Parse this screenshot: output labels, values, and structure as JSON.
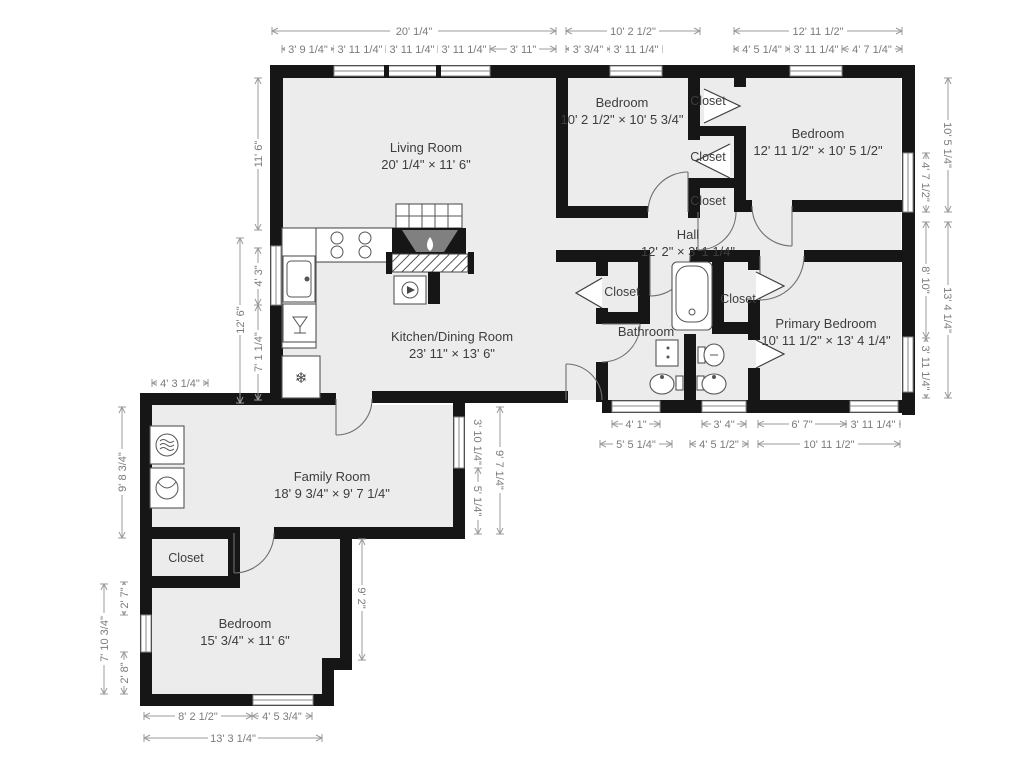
{
  "rooms": {
    "living": {
      "name": "Living Room",
      "dims": "20' 1/4\" × 11' 6\""
    },
    "bedroom1": {
      "name": "Bedroom",
      "dims": "10' 2 1/2\" × 10' 5 3/4\""
    },
    "bedroom2": {
      "name": "Bedroom",
      "dims": "12' 11 1/2\" × 10' 5 1/2\""
    },
    "hall": {
      "name": "Hall",
      "dims": "12' 2\" × 3' 1 1/4\""
    },
    "kitchen": {
      "name": "Kitchen/Dining Room",
      "dims": "23' 11\" × 13' 6\""
    },
    "bathroom": {
      "name": "Bathroom"
    },
    "primary": {
      "name": "Primary Bedroom",
      "dims": "10' 11 1/2\" × 13' 4 1/4\""
    },
    "family": {
      "name": "Family Room",
      "dims": "18' 9 3/4\" × 9' 7 1/4\""
    },
    "bedroom3": {
      "name": "Bedroom",
      "dims": "15' 3/4\" × 11' 6\""
    },
    "closet": "Closet"
  },
  "dims": {
    "top": {
      "living": "20' 1/4\"",
      "living_sub": [
        "3' 9 1/4\"",
        "3' 11 1/4\"",
        "3' 11 1/4\"",
        "3' 11 1/4\"",
        "3' 11\""
      ],
      "bedroom1": "10' 2 1/2\"",
      "bedroom1_sub": [
        "3' 3/4\"",
        "3' 11 1/4\""
      ],
      "bedroom2": "12' 11 1/2\"",
      "bedroom2_sub": [
        "4' 5 1/4\"",
        "3' 11 1/4\"",
        "4' 7 1/4\""
      ]
    },
    "left": {
      "living": "11' 6\"",
      "kitchen": "12' 6\"",
      "kitchen_sub": [
        "4' 3\"",
        "7' 1 1/4\""
      ]
    },
    "right": {
      "bedroom2": "10' 5 1/4\"",
      "bedroom2_sub": "4' 7 1/2\"",
      "primary": "13' 4 1/4\"",
      "primary_sub": [
        "8' 10\"",
        "3' 11 1/4\""
      ]
    },
    "bottom_main": {
      "bath_win": "4' 1\"",
      "bath_width": "5' 5 1/4\"",
      "ensuite_win": "3' 4\"",
      "ensuite_width": "4' 5 1/2\"",
      "primary_sub": [
        "6' 7\"",
        "3' 11 1/4\""
      ],
      "primary": "10' 11 1/2\""
    },
    "family": {
      "top": "4' 3 1/4\"",
      "left": "9' 8 3/4\"",
      "right": "9' 7 1/4\"",
      "right_sub": [
        "3' 10 1/4\"",
        "5' 1/4\""
      ]
    },
    "bedroom3": {
      "left": "7' 10 3/4\"",
      "left_sub": [
        "2' 7\"",
        "2' 8\""
      ],
      "right": "9' 2\"",
      "bottom": "13' 3 1/4\"",
      "bottom_sub": [
        "8' 2 1/2\"",
        "4' 5 3/4\""
      ]
    }
  },
  "icons": {
    "freezer": "❄"
  }
}
